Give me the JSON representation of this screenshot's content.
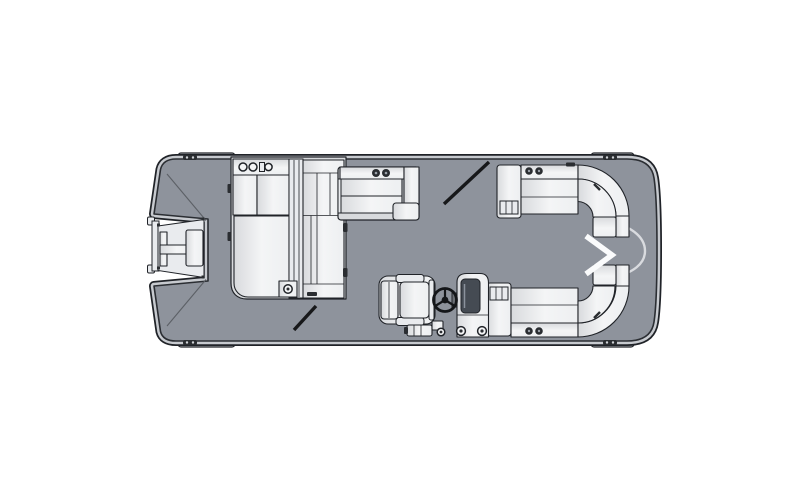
{
  "diagram": {
    "type": "boat-floorplan",
    "subject": "Pontoon boat deck layout, overhead (top-down) line drawing",
    "orientation": {
      "bow": "right",
      "stern": "left"
    },
    "visible_text": ""
  },
  "colors": {
    "background": "#FFFFFF",
    "deck": "#8E939C",
    "ink": "#202328",
    "rub-rail": "#C7CACF",
    "seat-light": "#F4F5F6",
    "seat-mid": "#E9EBEE",
    "seat-shade": "#D8DADD",
    "detail-dark": "#2A2D31",
    "screen": "#454B53",
    "chevron": "#FAFBFC",
    "contour": "#5C6066"
  },
  "components": [
    {
      "id": "swim-platform",
      "label": "Stern swim platform with boarding ladder"
    },
    {
      "id": "stern-lounge-group",
      "label": "Aft L-shaped lounge seating group with cup holders"
    },
    {
      "id": "port-mid-couch",
      "label": "Port side bench seat with armrest"
    },
    {
      "id": "port-gate",
      "label": "Port side entry gate shown open (diagonal swing mark)"
    },
    {
      "id": "bow-port-lounge",
      "label": "Port bow curved wraparound lounge"
    },
    {
      "id": "bow-starboard-lounge",
      "label": "Starboard bow curved wraparound lounge"
    },
    {
      "id": "bow-chevron",
      "label": "Bow walk-through chevron marker"
    },
    {
      "id": "captain-chair",
      "label": "Captain's helm chair"
    },
    {
      "id": "helm-console",
      "label": "Helm console with steering wheel and gauges"
    },
    {
      "id": "starboard-gate",
      "label": "Starboard aft entry gate shown open (diagonal swing mark)"
    },
    {
      "id": "cleats",
      "label": "Mooring cleats and corner rail fenders"
    },
    {
      "id": "hull",
      "label": "Pontoon hull outline with rub rail and gray deck"
    }
  ]
}
